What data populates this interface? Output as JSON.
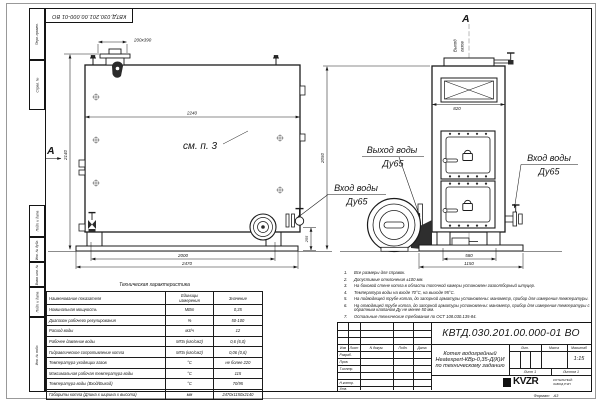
{
  "drawing": {
    "stamp_doc_number": "КВТД.030.201.00.000-01 ВО",
    "format_label": "Формат",
    "format_value": "А3"
  },
  "frame_columns": [
    "Перв. примен.",
    "Справ. №",
    "Подп. и дата",
    "Инв. № дубл.",
    "Взам. инв. №",
    "Подп. и дата",
    "Инв. № подл."
  ],
  "side_view": {
    "section_label": "А",
    "dim_stub": "200х390",
    "dim_width": "2240",
    "dim_height": "2140",
    "note_ref": "см. п. 3",
    "dim_base_inner": "2000",
    "dim_base_outer": "2470",
    "dim_valve_height": "255",
    "label_inlet_1": "Вход воды",
    "label_inlet_2": "Ду65"
  },
  "front_view": {
    "section_label": "А",
    "label_gas_1": "Выход",
    "label_gas_2": "газов",
    "dim_height": "2050",
    "dim_hatch_width": "820",
    "dim_base_inner": "580",
    "dim_base_outer": "1150",
    "label_outlet_1": "Выход воды",
    "label_outlet_2": "Ду65",
    "label_inlet_1": "Вход воды",
    "label_inlet_2": "Ду65"
  },
  "tech_table": {
    "title": "Техническая характеристика",
    "col_name": "Наименование показателя",
    "col_units_1": "Единицы",
    "col_units_2": "измерения",
    "col_value": "Значение",
    "rows": [
      {
        "name": "Номинальная мощность",
        "units": "МВт",
        "value": "0,35"
      },
      {
        "name": "Диапазон рабочего регулирования",
        "units": "%",
        "value": "50-100"
      },
      {
        "name": "Расход воды",
        "units": "м3/ч",
        "value": "12"
      },
      {
        "name": "Рабочее давление воды",
        "units": "МПа (кгс/см2)",
        "value": "0,6 (6,0)"
      },
      {
        "name": "Гидравлическое сопротивление котла",
        "units": "МПа (кгс/см2)",
        "value": "0,06 (0,6)"
      },
      {
        "name": "Температура уходящих газов",
        "units": "°С",
        "value": "не более 220"
      },
      {
        "name": "Максимальная рабочая температура воды",
        "units": "°С",
        "value": "115"
      },
      {
        "name": "Температура воды (Вход/Выход)",
        "units": "°С",
        "value": "70/95"
      },
      {
        "name": "Габариты котла (Длина х ширина х высота)",
        "units": "мм",
        "value": "2470х1150х2140"
      }
    ]
  },
  "notes": [
    {
      "n": "1.",
      "text": "Все размеры для справок."
    },
    {
      "n": "2.",
      "text": "Допустимые отклонения ±100 мм."
    },
    {
      "n": "3.",
      "text": "На боковой стене котла в области топочной камеры установлен газоотборный штуцер."
    },
    {
      "n": "4.",
      "text": "Температура воды на входе 70°С, на выходе 95°С."
    },
    {
      "n": "5.",
      "text": "На подводящей трубе котла, до запорной арматуры установлены: манометр, прибор для измерения температуры."
    },
    {
      "n": "6.",
      "text": "На отводящей трубе котла, до запорной арматуры установлены: манометр, прибор для измерения температуры с обратным клапаном Ду не менее 50 мм."
    },
    {
      "n": "7.",
      "text": "Остальные технические требования по ОСТ 108.030.135-84."
    }
  ],
  "title_block": {
    "doc_number": "КВТД.030.201.00.000-01 ВО",
    "product_line_1": "Котел водогрейный",
    "product_line_2": "Heatexpert-КВр-0,35-Д(К)И",
    "product_line_3": "по техническому заданию",
    "header": {
      "izm": "Изм",
      "list": "Лист",
      "docum": "N докум.",
      "podp": "Подп.",
      "data": "Дата"
    },
    "roles": [
      "Разраб.",
      "Пров.",
      "Т.контр.",
      "Н.контр.",
      "Утв."
    ],
    "lit_label": "Лит.",
    "mass_label": "Масса",
    "scale_label": "Масштаб",
    "scale_value": "1:15",
    "sheet": "Лист 1",
    "sheets": "Листов 1",
    "logo_text": "KVZR",
    "company_line_1": "КОТЕЛЬНЫЙ",
    "company_line_2": "ЗАВОД РЭП"
  }
}
